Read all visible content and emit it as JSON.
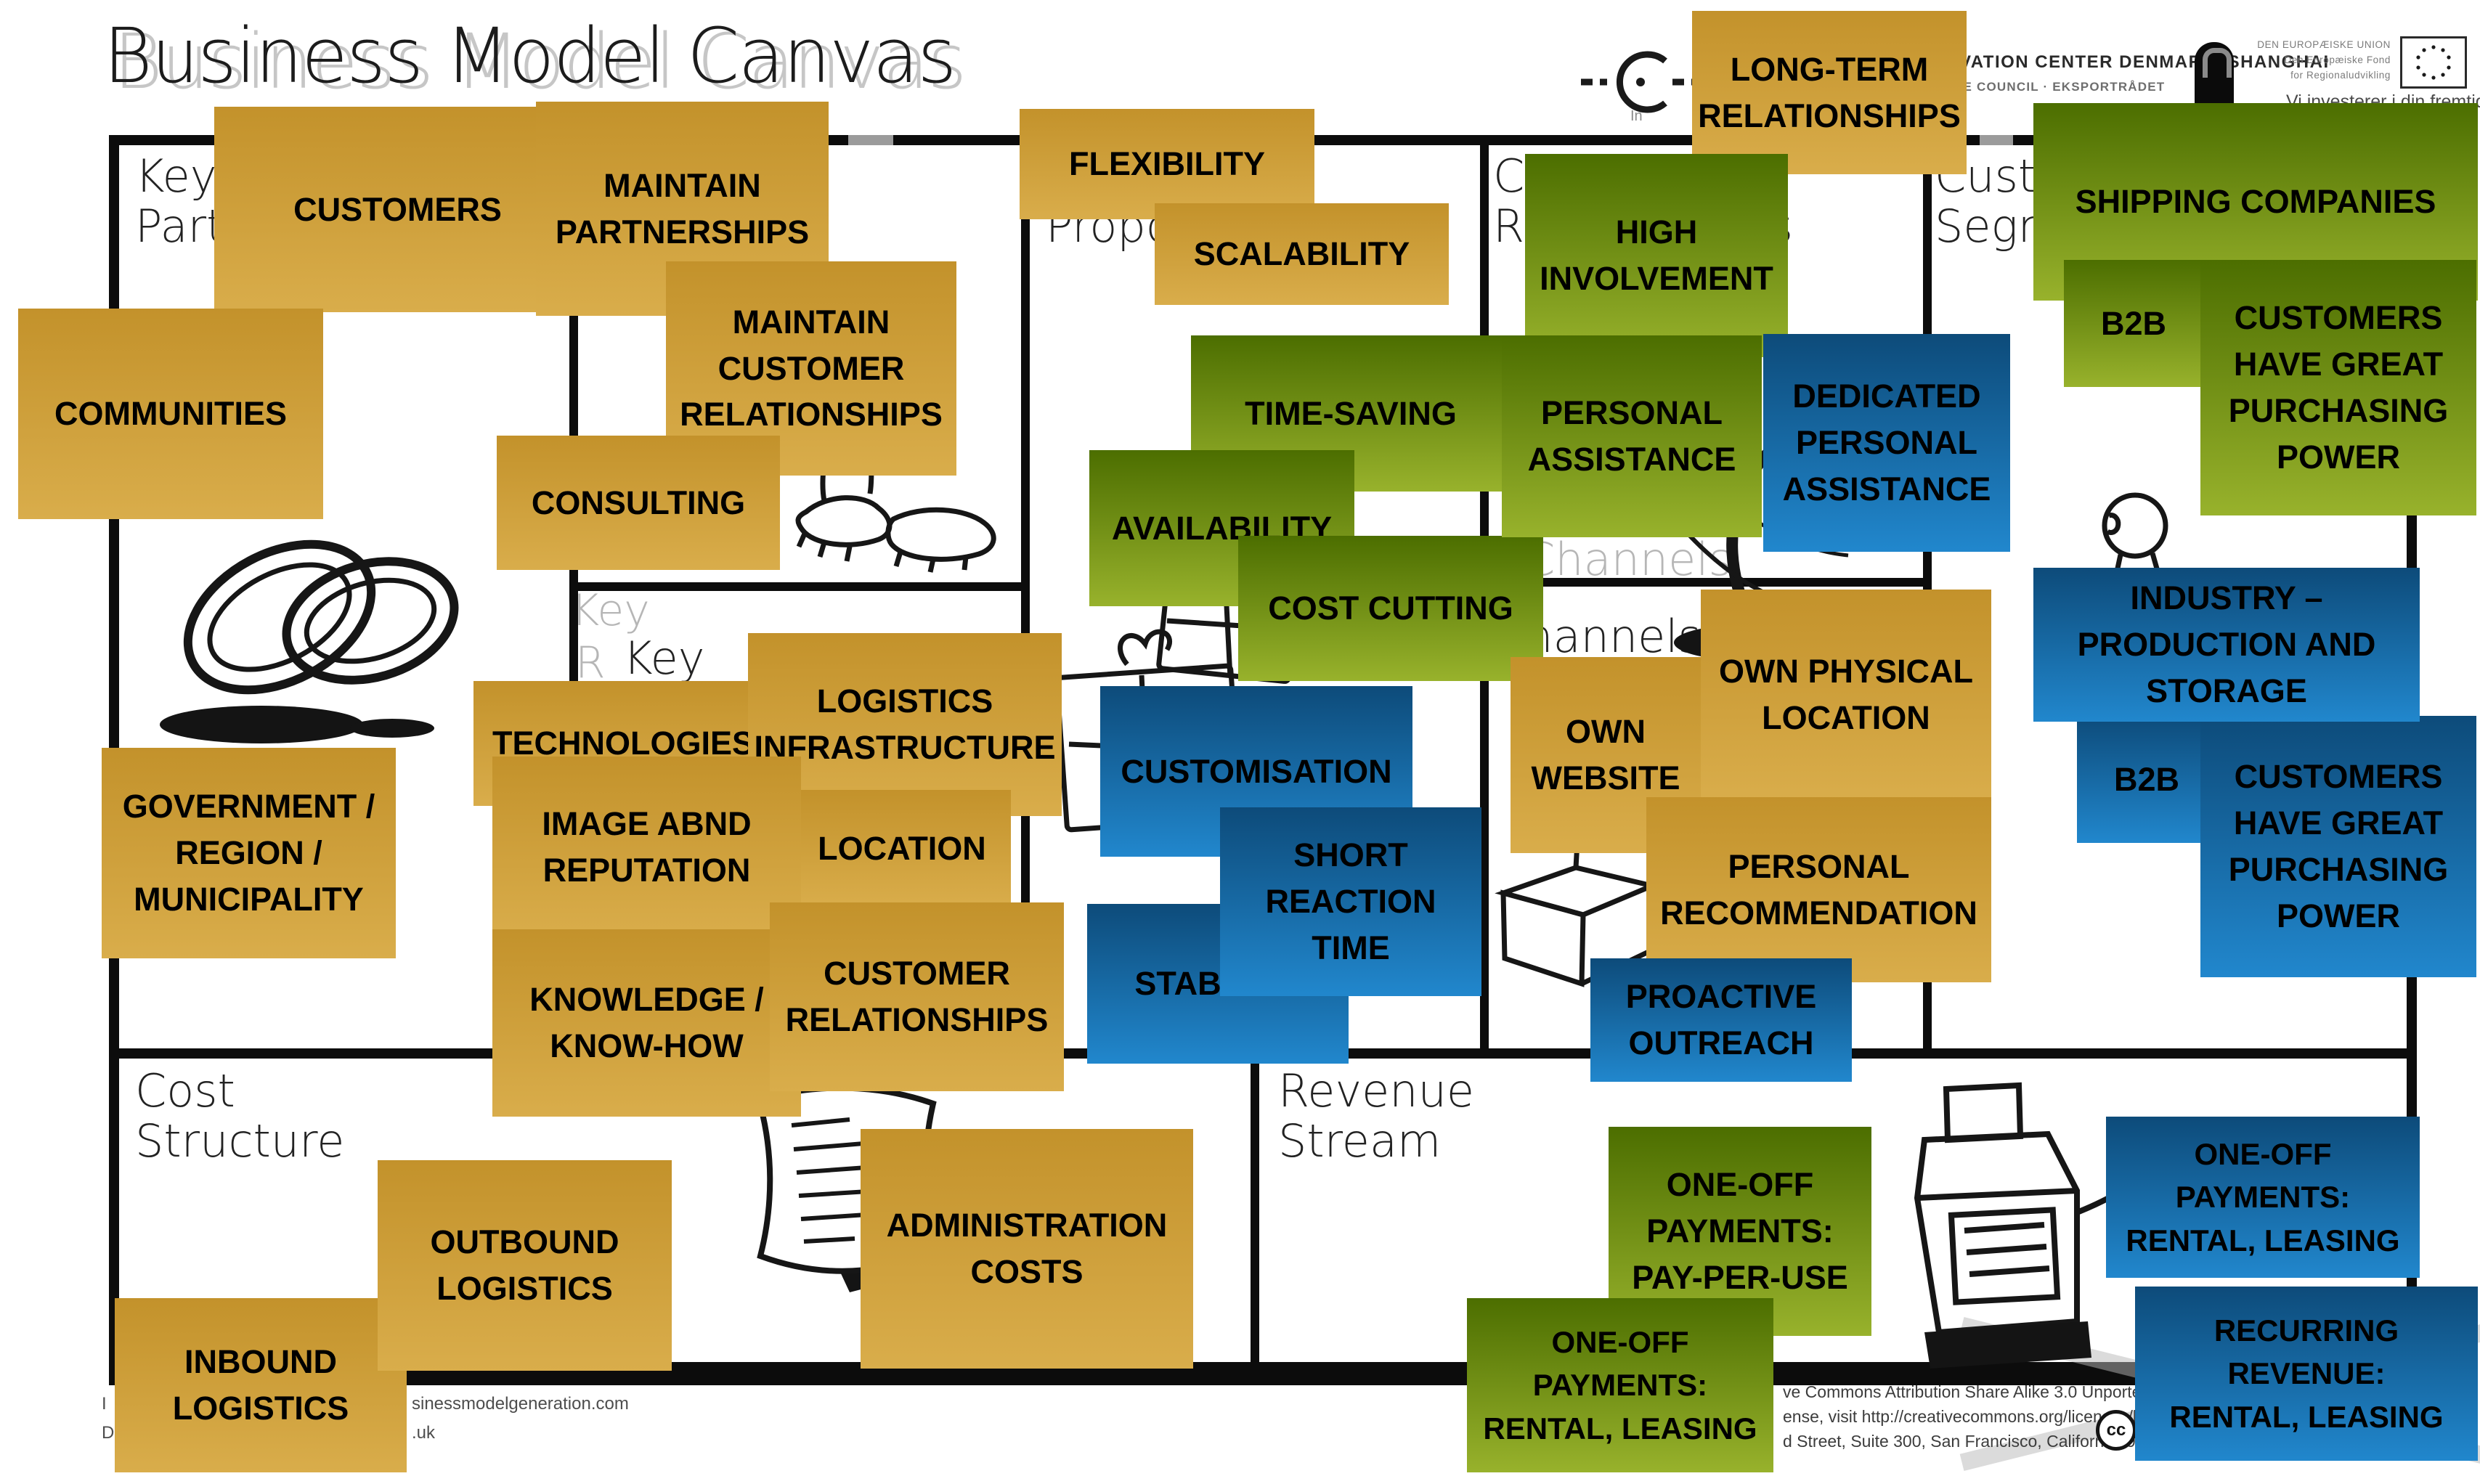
{
  "title": "Business Model Canvas",
  "watermark": {
    "title_ghost": "Business Model Canvas",
    "channels_ghost": "Channels",
    "key_ghost": "Key",
    "r_ghost": "R"
  },
  "header": {
    "partner_logo_symbol": "C",
    "partner_logo_sub": "In",
    "icdk_line1": "INNOVATION CENTER DENMARK, SHANGHAI",
    "icdk_line2": "THE TRADE COUNCIL · EKSPORTRÅDET",
    "eu_lines": "DEN EUROPÆISKE UNION\nDen Europæiske Fond\nfor Regionaludvikling",
    "eu_tagline": "Vi investerer i din fremtid"
  },
  "sections": {
    "key_partners": "Key\nPartners",
    "key_resources": "Key\nResources",
    "value_proposition": "Value\nProposition",
    "customer_relationships": "Customer\nRelationships",
    "customer_segments": "Customer\nSegments",
    "channels": "Channels",
    "cost_structure": "Cost\nStructure",
    "revenue_stream": "Revenue\nStream"
  },
  "colors": {
    "gold_top": "#c3922b",
    "gold_bottom": "#d9ad4b",
    "green_top": "#4c6e00",
    "green_bottom": "#98b22c",
    "blue_top": "#0d4b7a",
    "blue_bottom": "#2187cd",
    "grid": "#0c0c0c"
  },
  "notes": {
    "customers": {
      "color": "gold",
      "text": "CUSTOMERS"
    },
    "maintain_partnerships": {
      "color": "gold",
      "text": "MAINTAIN\nPARTNERSHIPS"
    },
    "maintain_customer_relationships": {
      "color": "gold",
      "text": "MAINTAIN\nCUSTOMER\nRELATIONSHIPS"
    },
    "communities": {
      "color": "gold",
      "text": "COMMUNITIES"
    },
    "consulting": {
      "color": "gold",
      "text": "CONSULTING"
    },
    "government": {
      "color": "gold",
      "text": "GOVERNMENT /\nREGION /\nMUNICIPALITY"
    },
    "flexibility": {
      "color": "gold",
      "text": "FLEXIBILITY"
    },
    "scalability": {
      "color": "gold",
      "text": "SCALABILITY"
    },
    "time_saving": {
      "color": "green",
      "text": "TIME-SAVING"
    },
    "availability": {
      "color": "green",
      "text": "AVAILABILITY"
    },
    "cost_cutting": {
      "color": "green",
      "text": "COST CUTTING"
    },
    "long_term": {
      "color": "gold",
      "text": "LONG-TERM\nRELATIONSHIPS"
    },
    "high_involvement": {
      "color": "green",
      "text": "HIGH\nINVOLVEMENT"
    },
    "personal_assistance": {
      "color": "green",
      "text": "PERSONAL\nASSISTANCE"
    },
    "dedicated_personal_assistance": {
      "color": "blue",
      "text": "DEDICATED\nPERSONAL\nASSISTANCE"
    },
    "shipping_companies": {
      "color": "green",
      "text": "SHIPPING COMPANIES"
    },
    "b2b_green": {
      "color": "green",
      "text": "B2B"
    },
    "purchasing_green": {
      "color": "green",
      "text": "CUSTOMERS\nHAVE GREAT\nPURCHASING\nPOWER"
    },
    "b2b_blue": {
      "color": "blue",
      "text": "B2B"
    },
    "purchasing_blue": {
      "color": "blue",
      "text": "CUSTOMERS\nHAVE GREAT\nPURCHASING\nPOWER"
    },
    "industry": {
      "color": "blue",
      "text": "INDUSTRY –\nPRODUCTION AND\nSTORAGE"
    },
    "technologies": {
      "color": "gold",
      "text": "TECHNOLOGIES"
    },
    "logistics_infrastructure": {
      "color": "gold",
      "text": "LOGISTICS\nINFRASTRUCTURE"
    },
    "location": {
      "color": "gold",
      "text": "LOCATION"
    },
    "image_reputation": {
      "color": "gold",
      "text": "IMAGE ABND\nREPUTATION"
    },
    "knowledge": {
      "color": "gold",
      "text": "KNOWLEDGE /\nKNOW-HOW"
    },
    "customer_relationships_note": {
      "color": "gold",
      "text": "CUSTOMER\nRELATIONSHIPS"
    },
    "customisation": {
      "color": "blue",
      "text": "CUSTOMISATION"
    },
    "stability": {
      "color": "blue",
      "text": "STABILITY"
    },
    "short_reaction_time": {
      "color": "blue",
      "text": "SHORT\nREACTION\nTIME"
    },
    "own_website": {
      "color": "gold",
      "text": "OWN\nWEBSITE"
    },
    "own_physical_location": {
      "color": "gold",
      "text": "OWN PHYSICAL\nLOCATION"
    },
    "personal_recommendation": {
      "color": "gold",
      "text": "PERSONAL\nRECOMMENDATION"
    },
    "proactive_outreach": {
      "color": "blue",
      "text": "PROACTIVE\nOUTREACH"
    },
    "inbound": {
      "color": "gold",
      "text": "INBOUND\nLOGISTICS"
    },
    "outbound": {
      "color": "gold",
      "text": "OUTBOUND\nLOGISTICS"
    },
    "admin_costs": {
      "color": "gold",
      "text": "ADMINISTRATION\nCOSTS"
    },
    "payperuse": {
      "color": "green",
      "text": "ONE-OFF\nPAYMENTS:\nPAY-PER-USE"
    },
    "oneoff_rental_green": {
      "color": "green",
      "text": "ONE-OFF\nPAYMENTS:\nRENTAL, LEASING"
    },
    "oneoff_rental_blue": {
      "color": "blue",
      "text": "ONE-OFF\nPAYMENTS:\nRENTAL, LEASING"
    },
    "recurring_revenue": {
      "color": "blue",
      "text": "RECURRING\nREVENUE:\nRENTAL, LEASING"
    }
  },
  "footer_left": {
    "line1_start": "I",
    "line1_end": "sinessmodelgeneration.com",
    "line2_start": "D",
    "line2_end": ".uk"
  },
  "license": {
    "line1": "ve Commons Attribution Share Alike 3.0 Unported Licen",
    "line2": "ense, visit http://creativecommons.org/licenses/by-sa/3.0/",
    "line3": "d Street, Suite 300, San Francisco, California, 94105, USA.",
    "icons": [
      "cc-icon",
      "person-icon",
      "dollar-icon",
      "share-alike-icon",
      "equals-icon"
    ],
    "cc_label": "cc",
    "dollar_label": "$",
    "equals_label": "="
  }
}
